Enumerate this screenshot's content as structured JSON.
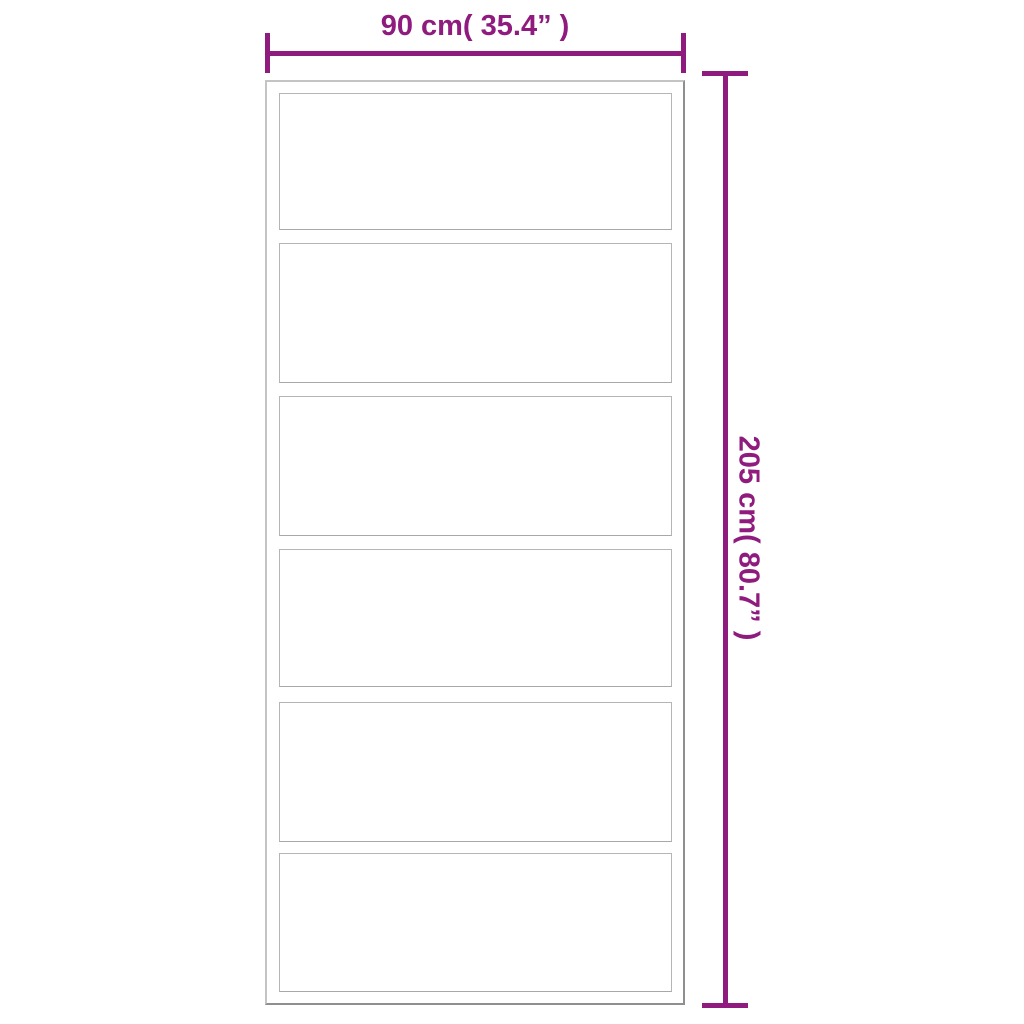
{
  "diagram": {
    "type": "product-dimension-diagram",
    "object": "sliding door with glass panels",
    "width_dimension": {
      "label": "90 cm( 35.4” )"
    },
    "height_dimension": {
      "label": "205 cm( 80.7” )"
    },
    "door": {
      "panel_count": 6
    },
    "colors": {
      "dimension_accent": "#8e1b7d",
      "frame_border_light": "#c4c4c4",
      "frame_border_dark": "#8f8f8f",
      "panel_border": "#b5b5b5"
    }
  }
}
